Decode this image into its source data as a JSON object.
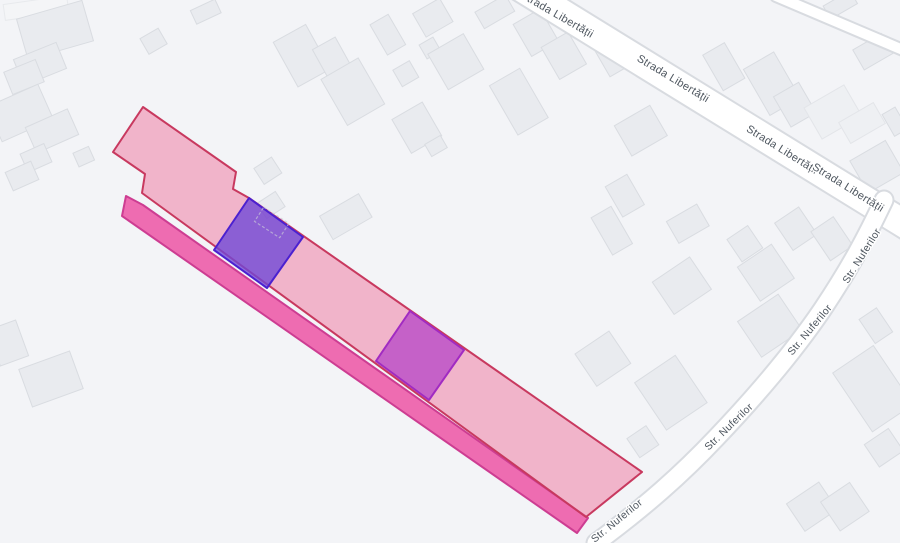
{
  "map": {
    "background_color": "#f3f4f7",
    "streets": {
      "strada_libertatii": {
        "name": "Strada Libertății"
      },
      "str_nuferilor": {
        "name": "Str. Nuferilor"
      }
    },
    "overlays": {
      "parcel_light_pink": {
        "fill": "rgba(238,91,140,0.42)",
        "stroke": "#c8395f"
      },
      "road_strip_magenta": {
        "fill": "rgba(236,56,150,0.72)",
        "stroke": "#cd3d92"
      },
      "subparcel_blue_purple": {
        "fill": "rgba(110,70,215,0.78)",
        "stroke": "#4b21d0"
      },
      "subparcel_magenta_purple": {
        "fill": "rgba(185,73,200,0.78)",
        "stroke": "#a12bc2"
      }
    }
  }
}
